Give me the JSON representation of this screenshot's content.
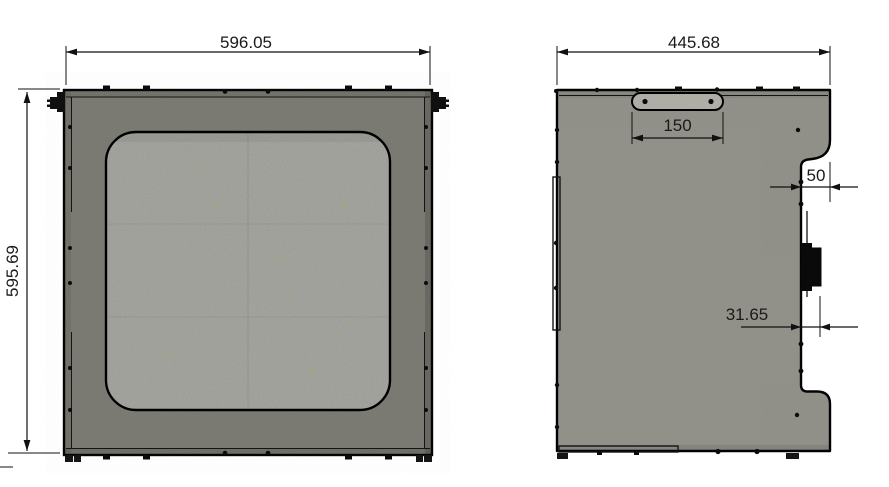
{
  "drawing": {
    "front_view": {
      "width_label": "596.05",
      "height_label": "595.69"
    },
    "side_view": {
      "width_label": "445.68",
      "slot_width_label": "150",
      "notch_width_label": "50",
      "connector_offset_label": "31.65"
    }
  },
  "colors": {
    "background": "#ffffff",
    "front_panel": "#797971",
    "window_glass": "#9c9c96",
    "side_panel": "#908f88",
    "handle_plate": "#adaca4",
    "outline": "#000000",
    "dimension_text": "#1a1a1a"
  }
}
